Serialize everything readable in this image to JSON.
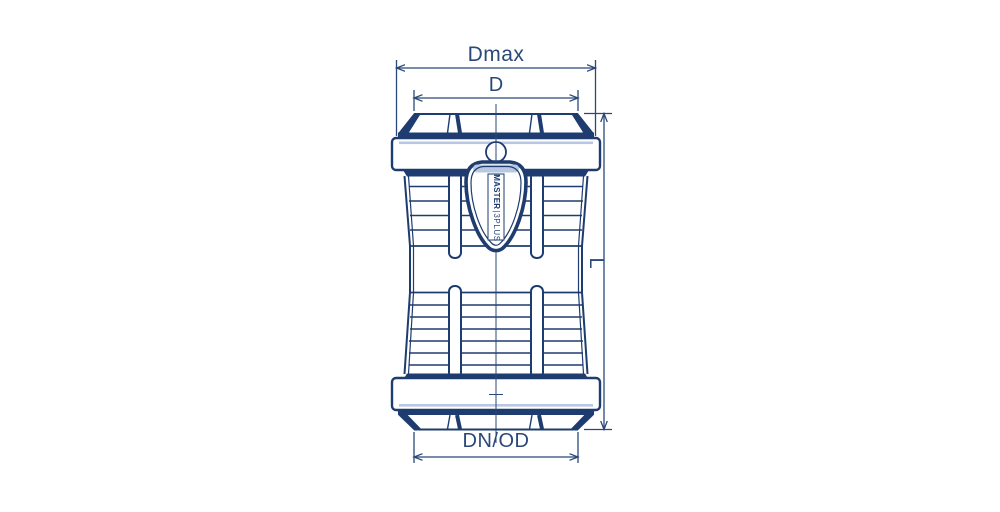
{
  "drawing": {
    "type": "technical-drawing",
    "subject": "pipe coupling, front elevation with dimensions",
    "product_label": {
      "brand": "MASTER",
      "separator": "|",
      "model": "3PLUS"
    },
    "dimension_labels": {
      "outer_diameter_max": "Dmax",
      "body_diameter": "D",
      "length": "L",
      "pipe_diameter": "DN/OD"
    },
    "colors": {
      "line": "#1e3c6f",
      "shading": "#b9c8e2",
      "background": "#ffffff"
    }
  }
}
